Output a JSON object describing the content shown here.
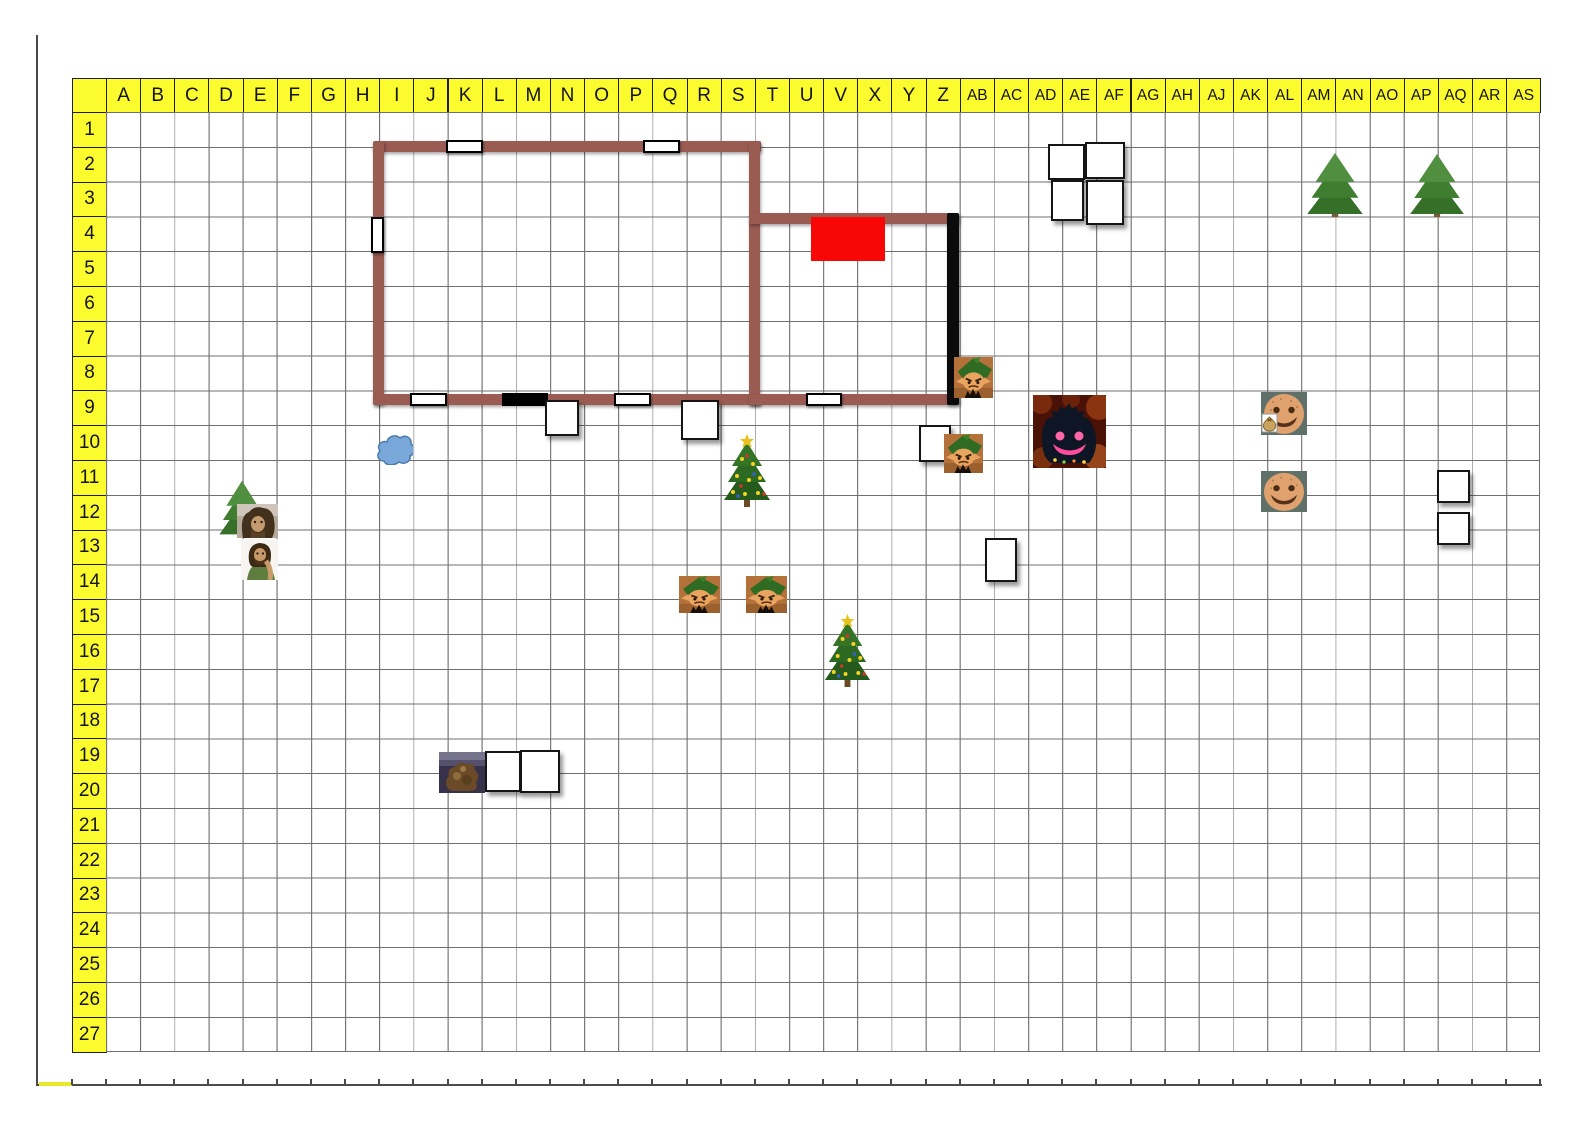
{
  "map": {
    "title": "christmas encounter battle grid",
    "columns": [
      "A",
      "B",
      "C",
      "D",
      "E",
      "F",
      "G",
      "H",
      "I",
      "J",
      "K",
      "L",
      "M",
      "N",
      "O",
      "P",
      "Q",
      "R",
      "S",
      "T",
      "U",
      "V",
      "X",
      "Y",
      "Z",
      "AB",
      "AC",
      "AD",
      "AE",
      "AF",
      "AG",
      "AH",
      "AJ",
      "AK",
      "AL",
      "AM",
      "AN",
      "AO",
      "AP",
      "AQ",
      "AR",
      "AS"
    ],
    "rows": [
      "1",
      "2",
      "3",
      "4",
      "5",
      "6",
      "7",
      "8",
      "9",
      "10",
      "11",
      "12",
      "13",
      "14",
      "15",
      "16",
      "17",
      "18",
      "19",
      "20",
      "21",
      "22",
      "23",
      "24",
      "25",
      "26",
      "27"
    ],
    "colors": {
      "header_bg": "#fbfb2e",
      "header_text": "#141414",
      "grid_line": "#6f6f6f",
      "wall_brown": "#9a5b53",
      "wall_black": "#0b0b0b",
      "door_white": "#ffffff",
      "red_zone": "#f90606",
      "cloud_blue": "#79a7d9",
      "tree_green": "#3f7d30",
      "xmas_green": "#2c6a22"
    },
    "objects": [
      {
        "name": "wall-main-room-top",
        "kind": "wall",
        "color": "brown",
        "cell": "I2:S2",
        "x": 373,
        "y": 141,
        "w": 388,
        "h": 11
      },
      {
        "name": "wall-main-room-left",
        "kind": "wall",
        "color": "brown",
        "cell": "I2:I8",
        "x": 373,
        "y": 141,
        "w": 11,
        "h": 264
      },
      {
        "name": "wall-main-room-right",
        "kind": "wall",
        "color": "brown",
        "cell": "T2:T8",
        "x": 749,
        "y": 141,
        "w": 11,
        "h": 264
      },
      {
        "name": "wall-main-room-bottom",
        "kind": "wall",
        "color": "brown",
        "cell": "I9:S9",
        "x": 373,
        "y": 394,
        "w": 388,
        "h": 11
      },
      {
        "name": "wall-annex-top",
        "kind": "wall",
        "color": "brown",
        "cell": "T4:Z4",
        "x": 749,
        "y": 213,
        "w": 210,
        "h": 11
      },
      {
        "name": "wall-annex-bottom",
        "kind": "wall",
        "color": "brown",
        "cell": "T9:Z9",
        "x": 749,
        "y": 394,
        "w": 210,
        "h": 11
      },
      {
        "name": "wall-annex-right-black",
        "kind": "wall",
        "color": "black",
        "cell": "Z4:Z8",
        "x": 947,
        "y": 213,
        "w": 12,
        "h": 192
      },
      {
        "name": "door-top-K2",
        "kind": "door-h",
        "cell": "K2",
        "x": 446,
        "y": 140,
        "w": 37,
        "h": 13
      },
      {
        "name": "door-top-Q2",
        "kind": "door-h",
        "cell": "Q2",
        "x": 643,
        "y": 140,
        "w": 37,
        "h": 13
      },
      {
        "name": "door-left-I4",
        "kind": "door-v",
        "cell": "I4",
        "x": 371,
        "y": 217,
        "w": 13,
        "h": 36
      },
      {
        "name": "door-bottom-J9",
        "kind": "door-h",
        "cell": "J9",
        "x": 410,
        "y": 393,
        "w": 37,
        "h": 13
      },
      {
        "name": "door-bottom-P9",
        "kind": "door-h",
        "cell": "P9",
        "x": 614,
        "y": 393,
        "w": 37,
        "h": 13
      },
      {
        "name": "door-annex-V9",
        "kind": "door-h",
        "cell": "V9",
        "x": 806,
        "y": 393,
        "w": 36,
        "h": 13
      },
      {
        "name": "black-bar-M9",
        "kind": "bar",
        "cell": "M9",
        "x": 502,
        "y": 393,
        "w": 46,
        "h": 13
      },
      {
        "name": "red-zone",
        "kind": "zone",
        "cell": "V4:X5",
        "x": 811,
        "y": 217,
        "w": 74,
        "h": 44
      },
      {
        "name": "blue-cloud-marker",
        "kind": "cloud",
        "cell": "I10",
        "x": 376,
        "y": 431,
        "w": 37,
        "h": 34
      },
      {
        "name": "token-square-N9",
        "kind": "square",
        "cell": "N9",
        "x": 545,
        "y": 400,
        "w": 34,
        "h": 36
      },
      {
        "name": "token-square-R9",
        "kind": "square",
        "cell": "R9",
        "x": 681,
        "y": 400,
        "w": 38,
        "h": 40
      },
      {
        "name": "token-square-Z10",
        "kind": "square",
        "cell": "Z10",
        "x": 919,
        "y": 425,
        "w": 32,
        "h": 37
      },
      {
        "name": "token-square-AE2",
        "kind": "square",
        "cell": "AE2",
        "x": 1048,
        "y": 144,
        "w": 37,
        "h": 36
      },
      {
        "name": "token-square-AF2",
        "kind": "square",
        "cell": "AF2",
        "x": 1085,
        "y": 142,
        "w": 40,
        "h": 37
      },
      {
        "name": "token-square-AE3",
        "kind": "square",
        "cell": "AE3",
        "x": 1051,
        "y": 180,
        "w": 33,
        "h": 41
      },
      {
        "name": "token-square-AF3",
        "kind": "square",
        "cell": "AF3",
        "x": 1086,
        "y": 180,
        "w": 38,
        "h": 45
      },
      {
        "name": "token-square-AC13",
        "kind": "square",
        "cell": "AC13",
        "x": 985,
        "y": 538,
        "w": 32,
        "h": 44
      },
      {
        "name": "token-square-AQ11",
        "kind": "square",
        "cell": "AQ11",
        "x": 1437,
        "y": 470,
        "w": 33,
        "h": 33
      },
      {
        "name": "token-square-AQ13",
        "kind": "square",
        "cell": "AQ13",
        "x": 1437,
        "y": 512,
        "w": 33,
        "h": 33
      },
      {
        "name": "token-square-L19",
        "kind": "square",
        "cell": "L19",
        "x": 485,
        "y": 751,
        "w": 36,
        "h": 41
      },
      {
        "name": "token-square-M19",
        "kind": "square",
        "cell": "M19",
        "x": 520,
        "y": 750,
        "w": 40,
        "h": 43
      },
      {
        "name": "pine-tree-AM2",
        "kind": "tree",
        "cell": "AM2:AN3",
        "x": 1303,
        "y": 151,
        "w": 64,
        "h": 66
      },
      {
        "name": "pine-tree-AP2",
        "kind": "tree",
        "cell": "AP2:AQ3",
        "x": 1406,
        "y": 152,
        "w": 62,
        "h": 65
      },
      {
        "name": "pine-tree-D11",
        "kind": "tree",
        "cell": "D11:E12",
        "x": 216,
        "y": 479,
        "w": 52,
        "h": 58
      },
      {
        "name": "xmas-tree-S10",
        "kind": "xmas-tree",
        "cell": "S10:T11",
        "x": 720,
        "y": 434,
        "w": 54,
        "h": 73
      },
      {
        "name": "xmas-tree-V15",
        "kind": "xmas-tree",
        "cell": "V15:V16",
        "x": 821,
        "y": 614,
        "w": 53,
        "h": 73
      },
      {
        "name": "elf-token-AB8",
        "kind": "elf",
        "cell": "AB8",
        "x": 954,
        "y": 357,
        "w": 39,
        "h": 41
      },
      {
        "name": "elf-token-AB10",
        "kind": "elf",
        "cell": "AB10",
        "x": 944,
        "y": 434,
        "w": 39,
        "h": 39
      },
      {
        "name": "elf-token-R14",
        "kind": "elf",
        "cell": "R14",
        "x": 679,
        "y": 576,
        "w": 41,
        "h": 37
      },
      {
        "name": "elf-token-T14",
        "kind": "elf",
        "cell": "T14",
        "x": 746,
        "y": 576,
        "w": 41,
        "h": 37
      },
      {
        "name": "shadow-monster-AD9",
        "kind": "monster",
        "cell": "AD9:AF10",
        "x": 1033,
        "y": 395,
        "w": 73,
        "h": 73
      },
      {
        "name": "gingerbread-token-AL9",
        "kind": "gingerbread-bag",
        "cell": "AL9",
        "x": 1261,
        "y": 392,
        "w": 46,
        "h": 43
      },
      {
        "name": "gingerbread-token-AL11",
        "kind": "gingerbread",
        "cell": "AL11",
        "x": 1261,
        "y": 471,
        "w": 46,
        "h": 41
      },
      {
        "name": "portrait-wildman-E12",
        "kind": "portrait-hairy",
        "cell": "E12",
        "x": 237,
        "y": 504,
        "w": 41,
        "h": 34
      },
      {
        "name": "portrait-ranger-E13",
        "kind": "portrait-green",
        "cell": "E13",
        "x": 241,
        "y": 539,
        "w": 37,
        "h": 41
      },
      {
        "name": "dark-creature-K19",
        "kind": "creature",
        "cell": "K19",
        "x": 439,
        "y": 752,
        "w": 46,
        "h": 41
      }
    ]
  }
}
